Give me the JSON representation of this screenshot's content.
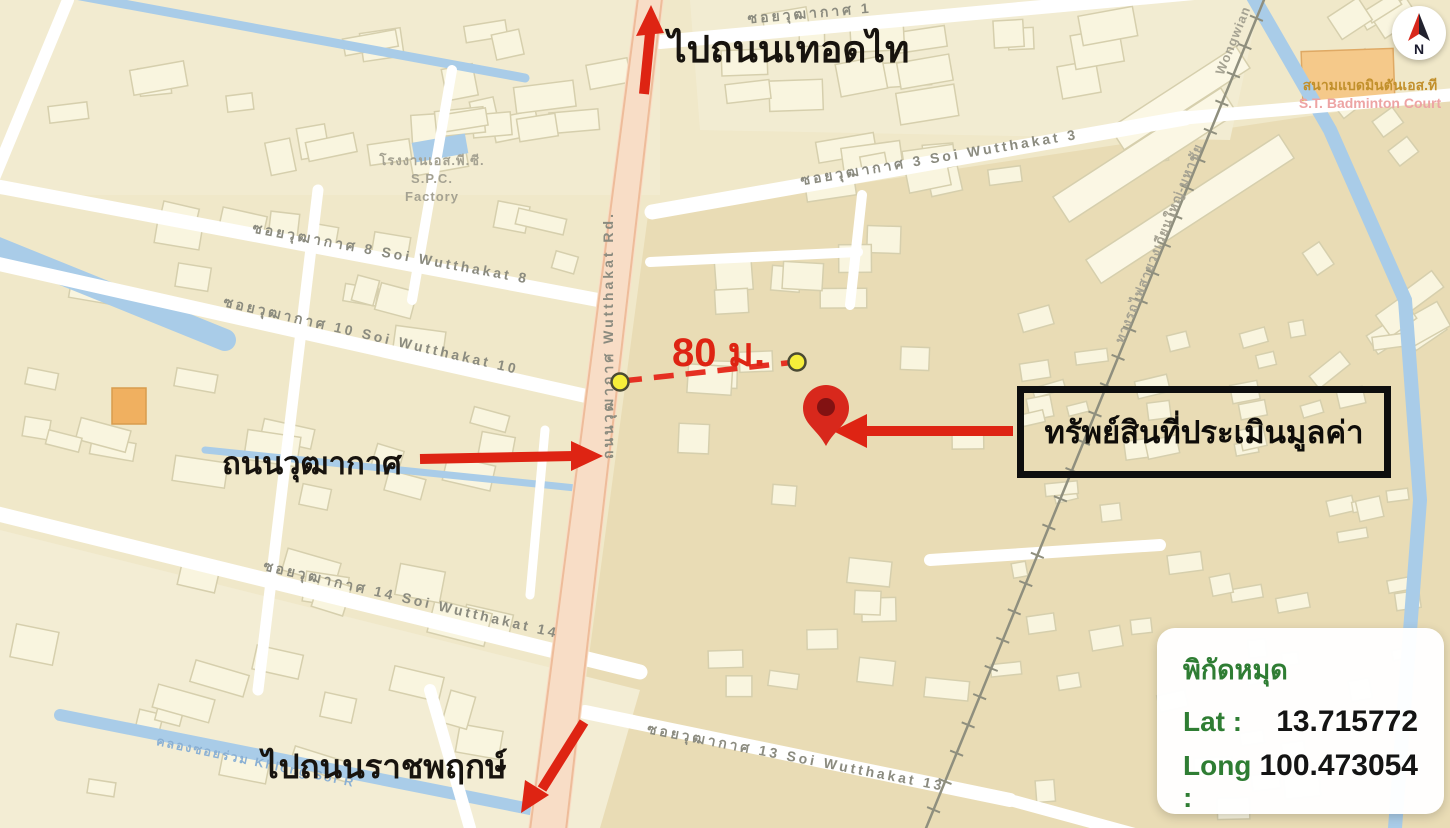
{
  "street_labels": [
    {
      "id": "soi-wutthakat-1",
      "text": "ซอยวุฒากาศ 1"
    },
    {
      "id": "soi-wutthakat-3",
      "text": "ซอยวุฒากาศ 3  Soi Wutthakat 3"
    },
    {
      "id": "soi-wutthakat-8",
      "text": "ซอยวุฒากาศ 8  Soi Wutthakat 8"
    },
    {
      "id": "soi-wutthakat-10",
      "text": "ซอยวุฒากาศ 10  Soi Wutthakat 10"
    },
    {
      "id": "soi-wutthakat-14",
      "text": "ซอยวุฒากาศ 14  Soi Wutthakat 14"
    },
    {
      "id": "soi-wutthakat-13",
      "text": "ซอยวุฒากาศ 13  Soi Wutthakat 13"
    },
    {
      "id": "wutthakat-road",
      "text": "ถนนวุฒากาศ  Wutthakat Rd."
    },
    {
      "id": "railway-line",
      "text": "ทางรถไฟสายวงเวียนใหญ่-มหาชัย"
    },
    {
      "id": "railway-wongwian",
      "text": "Wongwian"
    },
    {
      "id": "khlong-canal",
      "text": "คลองซอยร่วม  Khlong Soi R"
    }
  ],
  "poi": {
    "factory_line1": "โรงงานเอส.พี.ซี.",
    "factory_line2": "S.P.C.",
    "factory_line3": "Factory",
    "badminton_th": "สนามแบดมินตันเอส.ที",
    "badminton_en": "S.T. Badminton Court"
  },
  "annotations": {
    "to_thoedthai": "ไปถนนเทอดไท",
    "wutthakat_label": "ถนนวุฒากาศ",
    "to_ratchaphruek": "ไปถนนราชพฤกษ์",
    "property_label": "ทรัพย์สินที่ประเมินมูลค่า",
    "distance_label": "80 ม."
  },
  "coordinates_card": {
    "title": "พิกัดหมุด",
    "lat_label": "Lat :",
    "lat_value": "13.715772",
    "long_label": "Long :",
    "long_value": "100.473054"
  },
  "compass": {
    "letter": "N"
  },
  "colors": {
    "annotation_red": "#de2413",
    "coord_green": "#2f7d33",
    "canal_blue": "#a9cce8",
    "map_base": "#f0e8c9",
    "main_road_fill": "#f8ddc6",
    "pin_red": "#d8281c",
    "endpoint_yellow": "#f6ee3a"
  }
}
